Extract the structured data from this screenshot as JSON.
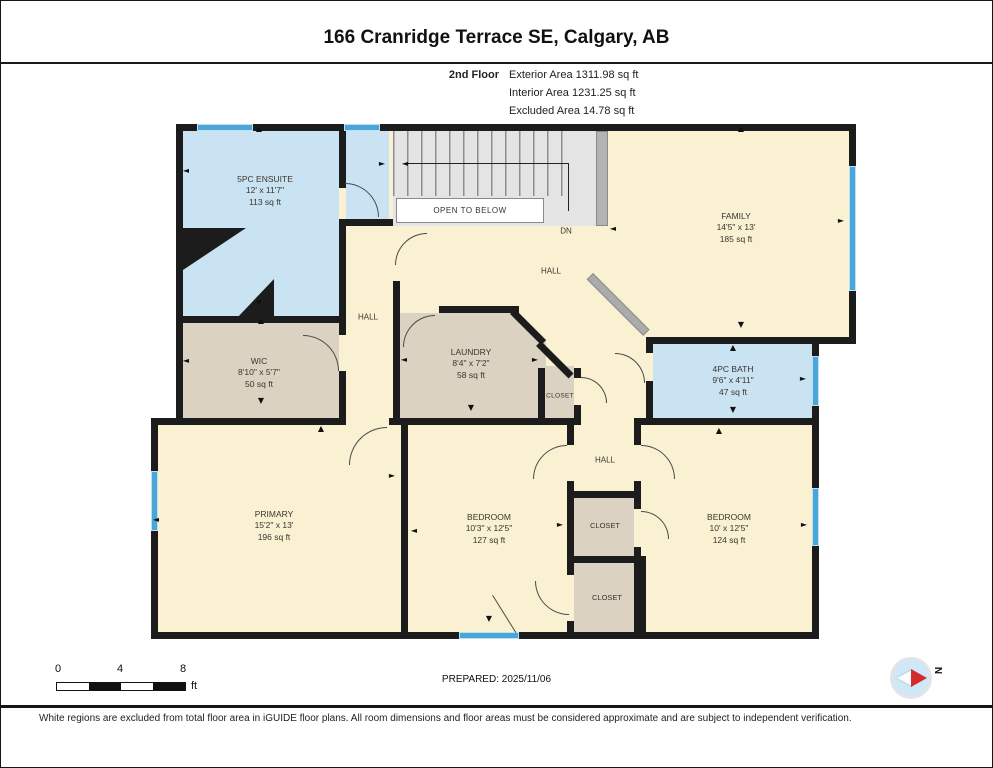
{
  "header": {
    "address": "166 Cranridge Terrace SE, Calgary, AB",
    "floor_label": "2nd Floor",
    "exterior_area": "Exterior Area 1311.98 sq ft",
    "interior_area": "Interior Area 1231.25 sq ft",
    "excluded_area": "Excluded Area 14.78 sq ft"
  },
  "plan": {
    "stairs": {
      "open_to_below_label": "OPEN TO BELOW",
      "down_label": "DN"
    },
    "rooms": {
      "ensuite": {
        "name": "5PC ENSUITE",
        "dims": "12' x 11'7\"",
        "area": "113 sq ft"
      },
      "family": {
        "name": "FAMILY",
        "dims": "14'5\" x 13'",
        "area": "185 sq ft"
      },
      "hall_upper": {
        "name": "HALL"
      },
      "hall_vertical": {
        "name": "HALL"
      },
      "wic": {
        "name": "WIC",
        "dims": "8'10\" x 5'7\"",
        "area": "50 sq ft"
      },
      "laundry": {
        "name": "LAUNDRY",
        "dims": "8'4\" x 7'2\"",
        "area": "58 sq ft"
      },
      "closet_laundry": {
        "name": "CLOSET"
      },
      "bath": {
        "name": "4PC BATH",
        "dims": "9'6\" x 4'11\"",
        "area": "47 sq ft"
      },
      "hall_lower": {
        "name": "HALL"
      },
      "closet_mid": {
        "name": "CLOSET"
      },
      "closet_lower": {
        "name": "CLOSET"
      },
      "primary": {
        "name": "PRIMARY",
        "dims": "15'2\" x 13'",
        "area": "196 sq ft"
      },
      "bedroom_mid": {
        "name": "BEDROOM",
        "dims": "10'3\" x 12'5\"",
        "area": "127 sq ft"
      },
      "bedroom_right": {
        "name": "BEDROOM",
        "dims": "10' x 12'5\"",
        "area": "124 sq ft"
      }
    },
    "symbols": {
      "up": "▲",
      "down": "▼",
      "left": "◄",
      "right": "►"
    }
  },
  "scale_bar": {
    "ticks": [
      "0",
      "4",
      "8"
    ],
    "unit": "ft"
  },
  "prepared_label": "PREPARED: 2025/11/06",
  "compass": {
    "north_label": "N"
  },
  "footer": {
    "disclaimer": "White regions are excluded from total floor area in iGUIDE floor plans. All room dimensions and floor areas must be considered approximate and are subject to independent verification."
  },
  "colors": {
    "wall": "#1c1c1c",
    "room_cream": "#faf1d2",
    "room_tan": "#dbd2c1",
    "room_blue": "#c9e3f3",
    "window_blue": "#4aa5d8",
    "stairs_gray": "#e4e4e4",
    "railing_gray": "#ababab"
  }
}
